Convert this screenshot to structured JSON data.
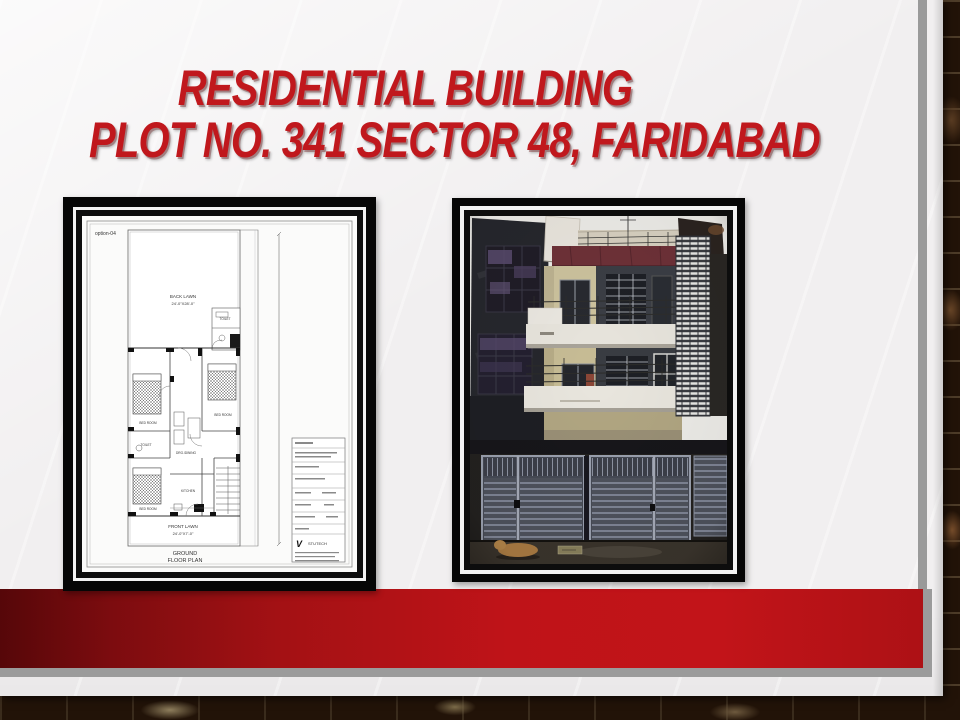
{
  "slide": {
    "title": {
      "line1": "RESIDENTIAL BUILDING",
      "line2": "PLOT NO. 341 SECTOR 48, FARIDABAD"
    },
    "accent_color": "#c0181d",
    "bar_gradient_dark": "#560709",
    "bar_gradient_bright": "#c21419",
    "paper_color": "#f1eff0",
    "frame_color": "#060606",
    "edge_gray": "#9b9b9b"
  },
  "floorplan": {
    "option_label": "option-04",
    "back_lawn_name": "BACK LAWN",
    "back_lawn_dim": "24'-0\"X28'-0\"",
    "front_lawn_name": "FRONT LAWN",
    "front_lawn_dim": "24'-0\"X7'-0\"",
    "caption_line1": "GROUND",
    "caption_line2": "FLOOR PLAN",
    "room_bed1": "BED ROOM",
    "room_bed2": "BED ROOM",
    "room_bed3": "BED ROOM",
    "room_toilet1": "TOILET",
    "room_toilet2": "TOILET",
    "room_kitchen": "KITCHEN",
    "room_dining": "DRG./DINING",
    "titleblock_logo_v": "V",
    "titleblock_logo": "STUTECH"
  }
}
